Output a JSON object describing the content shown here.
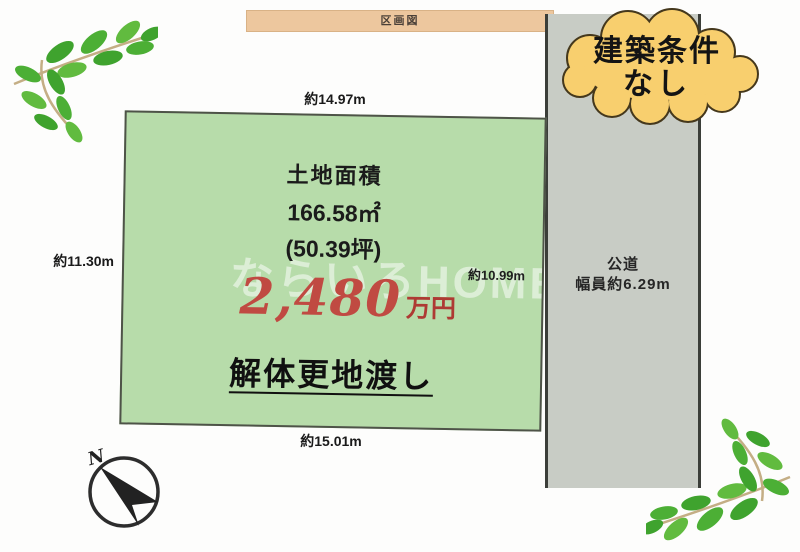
{
  "title_banner": {
    "label": "区画図",
    "bg": "#edc79e"
  },
  "badge_cloud": {
    "text_line1": "建築条件",
    "text_line2": "なし",
    "fill": "#f8cf6e",
    "outline": "#45381c"
  },
  "plot": {
    "fill": "#b7dcaa",
    "land_area_label": "土地面積",
    "land_area_sqm": "166.58㎡",
    "land_area_tsubo": "(50.39坪)",
    "price_value": "2,480",
    "price_unit": "万円",
    "price_color": "#c04a42",
    "handover_note": "解体更地渡し",
    "watermark": "ならいろHOME"
  },
  "dimensions": {
    "top": "約14.97m",
    "left": "約11.30m",
    "right": "約10.99m",
    "bottom": "約15.01m"
  },
  "road": {
    "name": "公道",
    "width_note": "幅員約6.29m",
    "fill": "#c8ccc5"
  },
  "compass": {
    "north_label": "N"
  }
}
